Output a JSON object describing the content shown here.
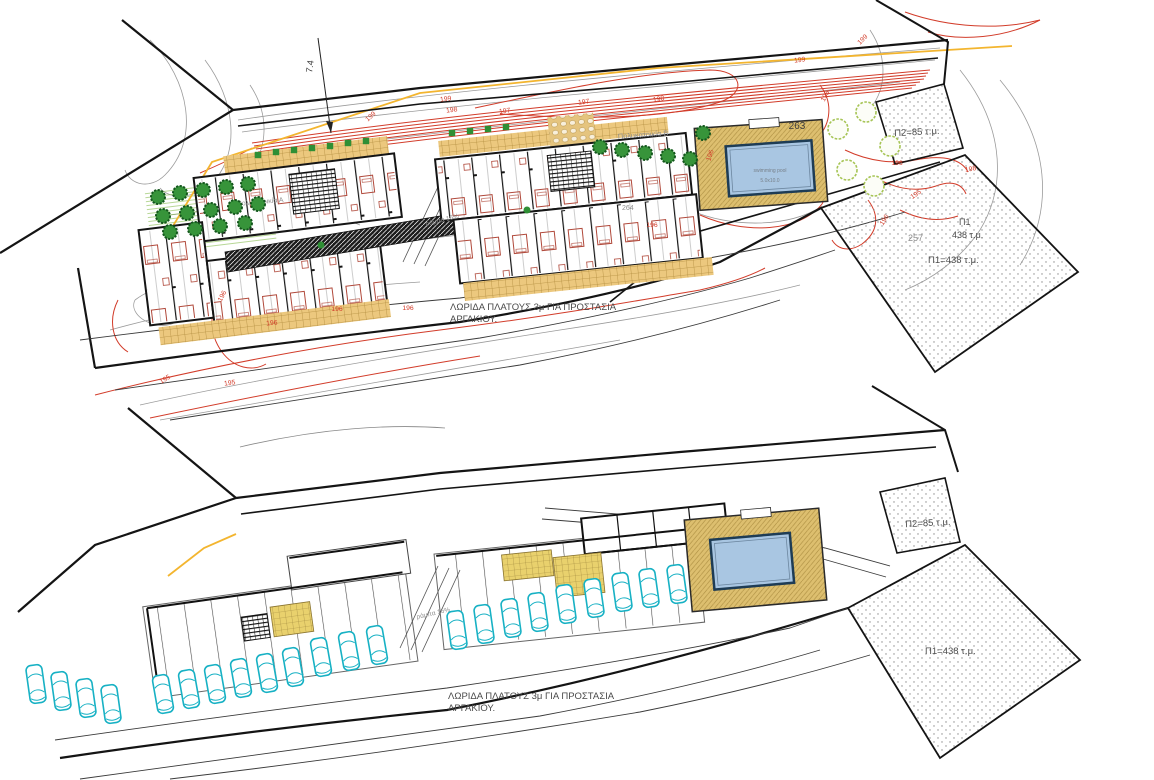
{
  "top_plan": {
    "dimension_label": "7.4",
    "building_a_label": "Πολυκατοικία Α",
    "building_b_label": "Πολυκατοικία Β",
    "building_b_spot_label": "264",
    "ramp_label": "ράμπα 16%",
    "pool_label_line1": "swimming pool",
    "pool_label_line2": "5.0x10.0",
    "deck_spot_label": "263",
    "p1_spot_label": "257",
    "area_p2_label": "Π2=85 τ.μ.",
    "area_p1_label_line1": "Π1",
    "area_p1_label_line2": "438 τ.μ.",
    "area_p1_eq_label": "Π1=438 τ.μ.",
    "strip_note_line1": "ΛΩΡΙΔΑ ΠΛΑΤΟΥΣ 3μ ΓΙΑ  ΠΡΟΣΤΑΣΙΑ",
    "strip_note_line2": "ΑΡΓΑΚΙΟΥ.",
    "contour_labels": [
      "199",
      "199",
      "198",
      "197",
      "197",
      "198",
      "199",
      "199",
      "198",
      "196",
      "196",
      "196",
      "195",
      "196",
      "198",
      "196",
      "196",
      "196",
      "195",
      "195",
      "196"
    ]
  },
  "bottom_plan": {
    "ramp_label": "ράμπα 16%",
    "area_p2_label": "Π2=85 τ.μ.",
    "area_p1_eq_label": "Π1=438 τ.μ.",
    "strip_note_line1": "ΛΩΡΙΔΑ ΠΛΑΤΟΥΣ 3μ ΓΙΑ  ΠΡΟΣΤΑΣΙΑ",
    "strip_note_line2": "ΑΡΓΑΚΙΟΥ."
  },
  "colors": {
    "contour_major_red": "#d23c2a",
    "contour_minor_gray": "#9b9b9b",
    "site_boundary_black": "#141414",
    "road_edge_yellow": "#f3b52f",
    "tree_green": "#37943a",
    "tree_outline_light_green": "#a6c455",
    "terrace_paving_tan": "#ecc87e",
    "pool_deck_tan": "#ddbf6f",
    "pool_water_blue": "#a9c6e2",
    "furniture_red": "#b0483a",
    "car_cyan": "#17b1c4",
    "stair_yellow": "#e9d16d"
  }
}
